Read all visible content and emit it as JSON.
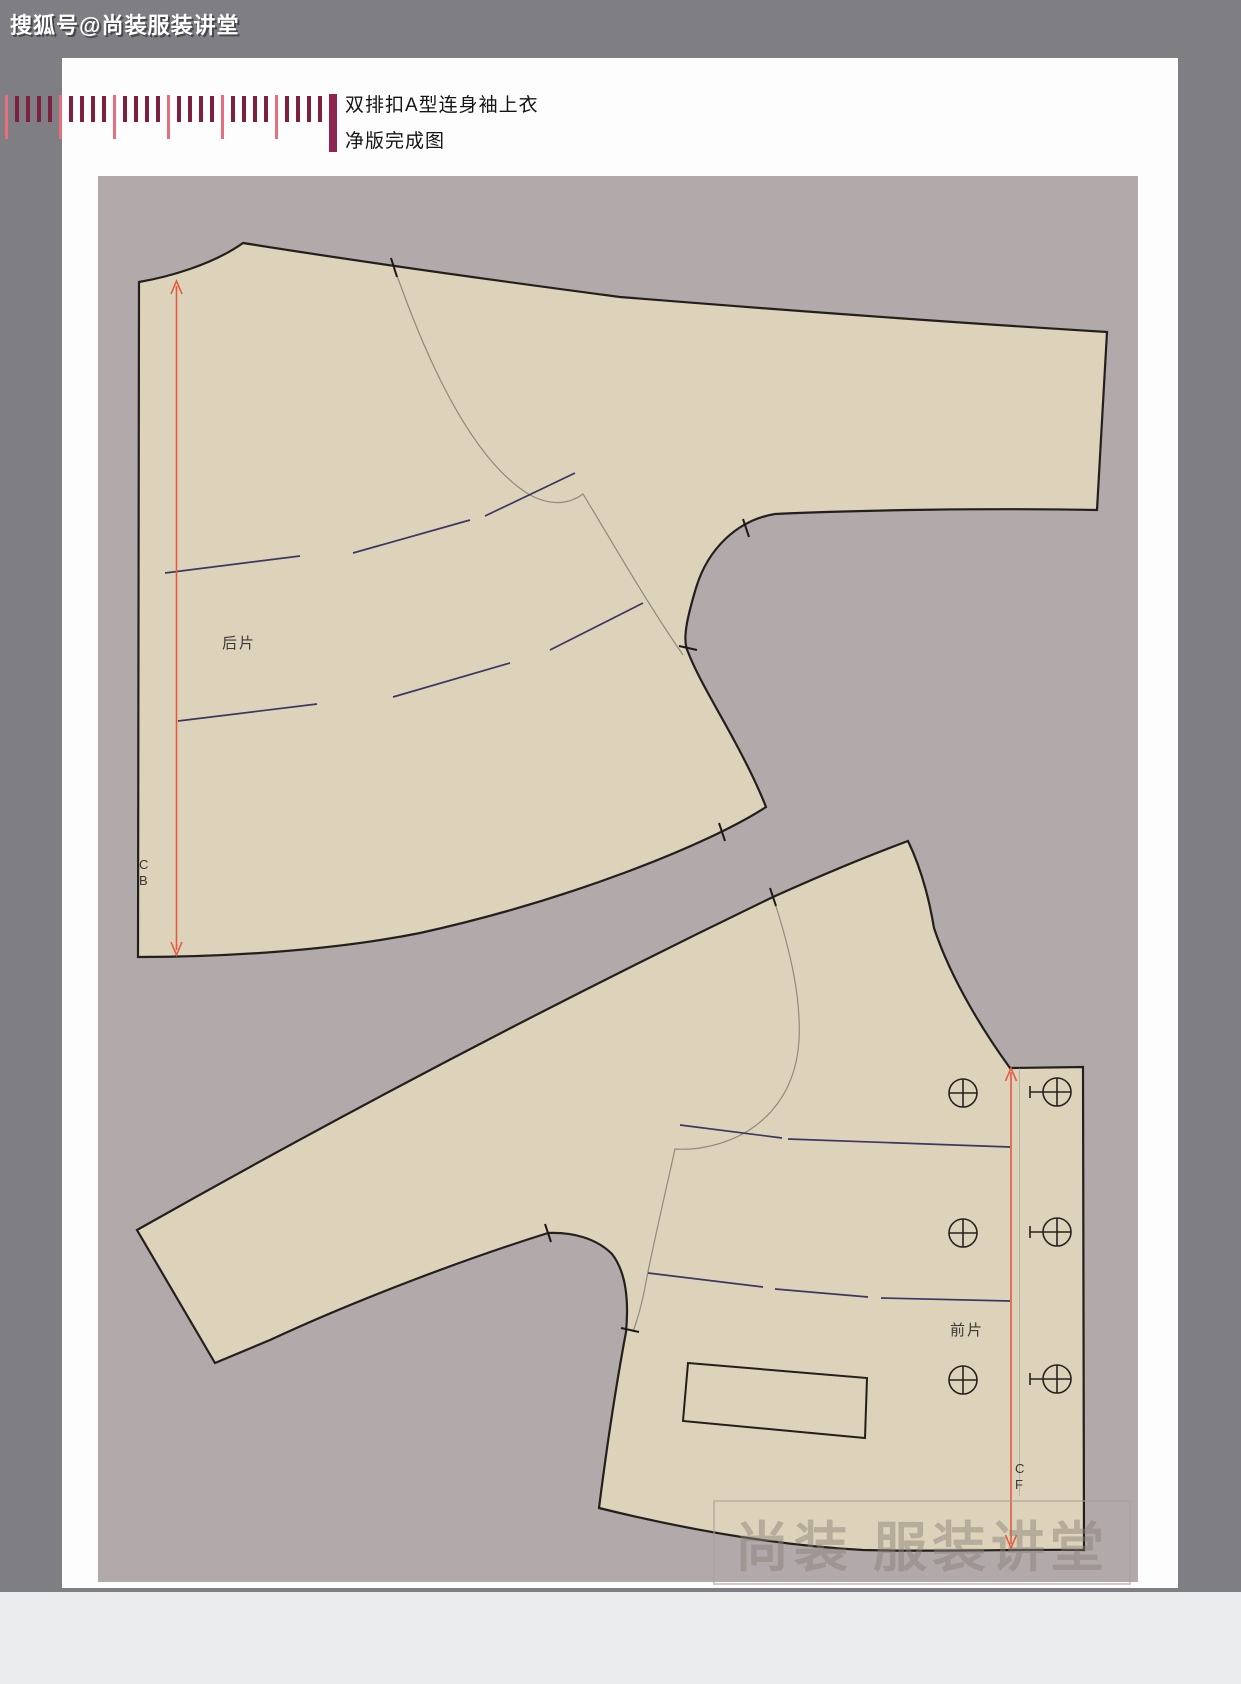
{
  "header": {
    "overlay_text": "搜狐号@尚装服装讲堂",
    "title_line1": "双排扣A型连身袖上衣",
    "title_line2": "净版完成图"
  },
  "pieces": {
    "back": {
      "label": "后片",
      "grain_top": "C",
      "grain_bottom": "B"
    },
    "front": {
      "label": "前片",
      "grain_top": "C",
      "grain_bottom": "F"
    }
  },
  "watermark": {
    "text": "尚装 服装讲堂"
  },
  "colors": {
    "outer_bg": "#7f7f83",
    "page_bg": "#fdfdfd",
    "field_bg": "#b2a9ab",
    "piece_fill": "#ddd3ba",
    "outline": "#231f1d",
    "seam_gray": "#8f897f",
    "style_dash": "#3c3663",
    "grainline_red": "#e25a41",
    "tick_dark": "#7d2040",
    "tick_pink": "#e56e7f",
    "ruler_bar": "#8e2550"
  }
}
